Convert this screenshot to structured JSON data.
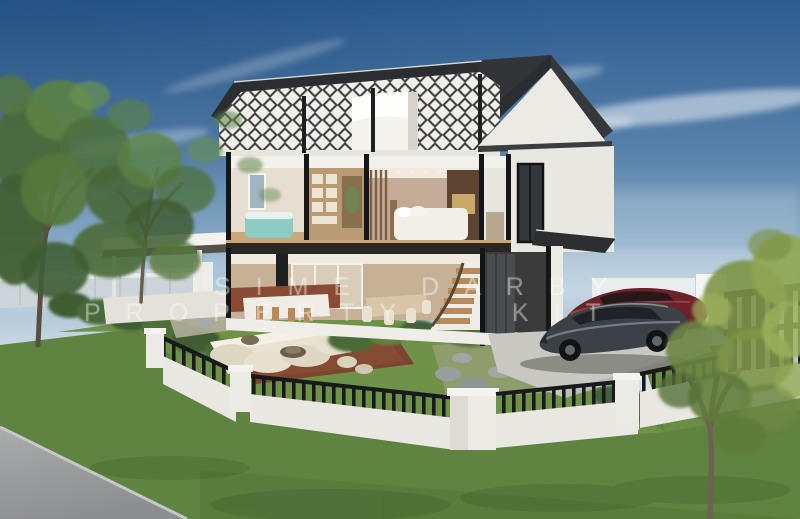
{
  "image": {
    "type": "architectural-3d-render",
    "subject": "Two-storey house cutaway (cross-section) showing furnished interior, landscaped corner-lot garden with outdoor lounge, perimeter fence, driveway with two cars and mature trees",
    "width_px": 800,
    "height_px": 519
  },
  "watermark": {
    "line1": "SIME DARBY",
    "line2": "PROPERTY",
    "line2_fragment": "KIT",
    "partially_obscured": true,
    "color": "#ffffff",
    "opacity": 0.36
  },
  "scene": {
    "house": {
      "storeys": 2,
      "style": "cutaway section render",
      "roof": "charcoal gable roof with exposed black diamond lattice trusses",
      "upper_rooms": [
        "bedroom with teal bed",
        "walk-in wardrobe",
        "master bedroom with white bed and TV wall",
        "white side room"
      ],
      "ground_rooms": [
        "kitchen with island and bar stools",
        "dining area",
        "curved staircase",
        "garage"
      ]
    },
    "vehicles": [
      {
        "name": "graphite-sedan",
        "color": "#3c4147"
      },
      {
        "name": "maroon-car",
        "color": "#6e2127"
      }
    ],
    "landscape": [
      "large left tree",
      "small right tree",
      "hedges",
      "outdoor cream lounge sofa on terracotta deck",
      "stepping stones",
      "white fence with black railings",
      "tall black gate",
      "road bottom-left"
    ]
  },
  "colors": {
    "sky_top": "#2d5c8f",
    "sky_mid": "#8fb0c9",
    "sky_horizon": "#e9edf0",
    "roof": "#2b2d30",
    "truss": "#27292c",
    "wall_white": "#f1f0ec",
    "interior_warm": "#c6b096",
    "teal_bed": "#8ecbc3",
    "terracotta_deck": "#7c452f",
    "sofa_cream": "#e9e3d3",
    "lawn_garden": "#6f9148",
    "lawn_foreground": "#5f8340",
    "road": "#9a9b9d",
    "fence_white": "#e9e8e3",
    "railing_black": "#1a1c1e",
    "car_gray": "#3c4147",
    "car_red": "#6e2127",
    "tree_green": "#5d8245",
    "tree_yellow_green": "#8fa653",
    "driveway": "#c9c8c3"
  }
}
